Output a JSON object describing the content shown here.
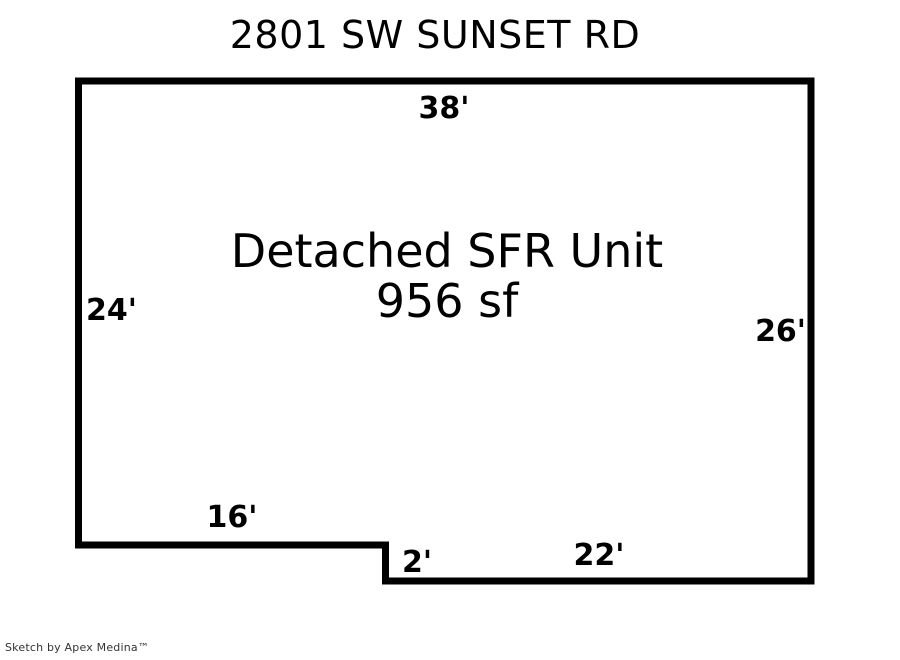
{
  "title": "2801 SW SUNSET RD",
  "unit": {
    "name": "Detached SFR Unit",
    "area": "956 sf"
  },
  "dimensions": {
    "top": "38'",
    "left": "24'",
    "right": "26'",
    "bottom_left": "16'",
    "step": "2'",
    "bottom_right": "22'"
  },
  "footer": "Sketch by Apex Medina™",
  "colors": {
    "outline": "#000000",
    "background": "#ffffff",
    "label_text": "#000000",
    "footer_text": "#333333"
  }
}
